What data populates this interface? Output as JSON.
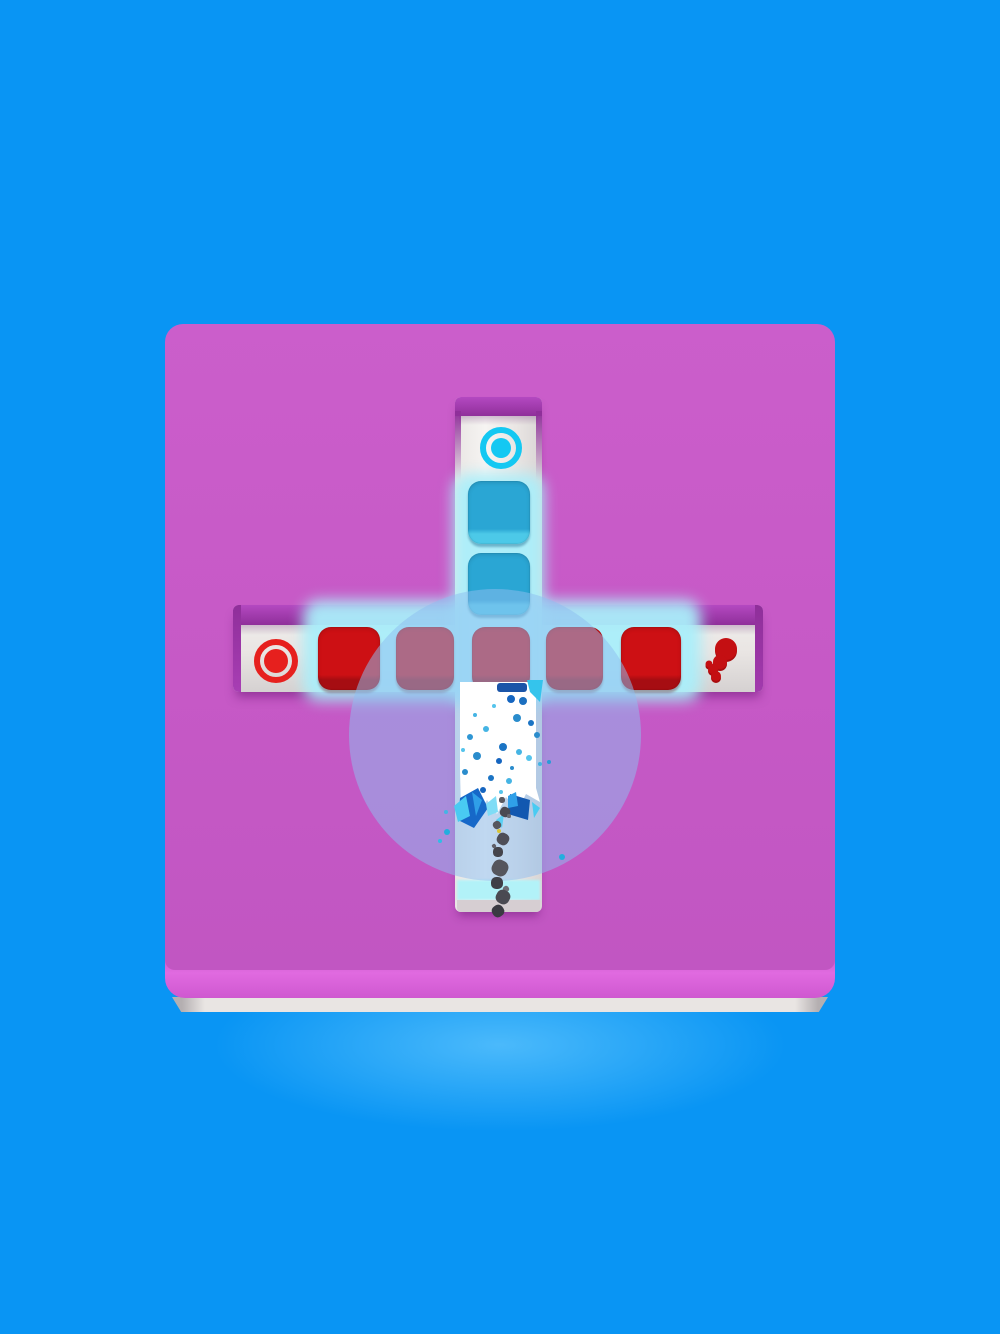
{
  "scene": {
    "width": 1000,
    "height": 1334,
    "app": "block-push-paint-puzzle"
  },
  "colors": {
    "background_blue": "#0995f4",
    "board_pink": "#c75ac7",
    "board_bevel_pink": "#d55fd7",
    "board_base_gray": "#e6e2e0",
    "groove_lip_purple": "#9d39aa",
    "track_white": "#f6f4f2",
    "glow_cyan": "#bdeef8",
    "blue_block": "#2aa6d4",
    "blue_block_bevel": "#4cc9e8",
    "red_block": "#cd1014",
    "red_block_bevel": "#a30d12",
    "ring_cyan": "#14c8f2",
    "ring_red": "#e6201e",
    "splat_red": "#c40f12",
    "splat_red_dark": "#a80b0e",
    "overlay_lavender": "rgba(141,189,240,0.52)",
    "paint_white": "#ffffff",
    "cyan_band": "#b2f2f8",
    "track_end_gray": "#d6ced2",
    "crystal_dark_blue": "#1668c8",
    "crystal_blue": "#2f9fe8",
    "crystal_cyan": "#49cbf2",
    "yellow_speck": "#d8c438"
  },
  "blocks": [
    {
      "name": "blue-block-1",
      "x": 468,
      "y": 481,
      "w": 62,
      "h": 63,
      "top": "#2aa6d4",
      "bevel": "#4cc9e8",
      "shadow": "rgba(10,90,130,0.4)"
    },
    {
      "name": "blue-block-2",
      "x": 468,
      "y": 553,
      "w": 62,
      "h": 62,
      "top": "#2aa6d4",
      "bevel": "#4cc9e8",
      "shadow": "rgba(10,90,130,0.4)"
    },
    {
      "name": "red-block-1",
      "x": 318,
      "y": 627,
      "w": 62,
      "h": 63,
      "top": "#cd1014",
      "bevel": "#a60d12",
      "shadow": "rgba(110,8,14,0.35)"
    },
    {
      "name": "red-block-2",
      "x": 396,
      "y": 627,
      "w": 58,
      "h": 63,
      "top": "#cd1014",
      "bevel": "#a60d12",
      "shadow": "rgba(110,8,14,0.35)"
    },
    {
      "name": "red-block-3",
      "x": 472,
      "y": 627,
      "w": 58,
      "h": 63,
      "top": "#cd1014",
      "bevel": "#a60d12",
      "shadow": "rgba(110,8,14,0.35)"
    },
    {
      "name": "red-block-4",
      "x": 546,
      "y": 627,
      "w": 57,
      "h": 63,
      "top": "#cd1014",
      "bevel": "#a60d12",
      "shadow": "rgba(110,8,14,0.35)"
    },
    {
      "name": "red-block-5",
      "x": 621,
      "y": 627,
      "w": 60,
      "h": 63,
      "top": "#cd1014",
      "bevel": "#a60d12",
      "shadow": "rgba(110,8,14,0.35)"
    }
  ],
  "targets": [
    {
      "name": "blue-goal-ring",
      "cx": 501,
      "cy": 448,
      "outer": 42,
      "stroke": 6,
      "dot": 20,
      "color": "#14c8f2"
    },
    {
      "name": "red-goal-ring",
      "cx": 276,
      "cy": 661,
      "outer": 44,
      "stroke": 6,
      "dot": 24,
      "color": "#e6201e"
    }
  ],
  "overlay_circle": {
    "cx": 495,
    "cy": 735,
    "r": 146,
    "fill": "rgba(141,189,240,0.52)"
  },
  "paint": {
    "white_polygon": "8,2 84,2 84,108 88,122 74,114 66,130 54,117 45,134 35,120 25,135 16,121 9,130 8,90",
    "navy_streak": {
      "x": 497,
      "y": 683,
      "w": 30,
      "h": 9,
      "color": "#1b55a8"
    },
    "cyan_streak_points": "75,0 91,0 88,22 78,12",
    "cyan_streak_color": "#34c4ec",
    "blue_dots": [
      [
        511,
        699,
        4,
        "#1565c0"
      ],
      [
        523,
        701,
        4,
        "#1b6fc0"
      ],
      [
        517,
        718,
        4,
        "#2a8ccc"
      ],
      [
        486,
        729,
        3,
        "#45b4e4"
      ],
      [
        470,
        737,
        3,
        "#2f96d4"
      ],
      [
        503,
        747,
        4,
        "#1b74c4"
      ],
      [
        519,
        752,
        3,
        "#45b4e4"
      ],
      [
        477,
        756,
        4,
        "#2a8ccc"
      ],
      [
        499,
        761,
        3,
        "#1565c0"
      ],
      [
        529,
        758,
        3,
        "#55c4ec"
      ],
      [
        465,
        772,
        3,
        "#2a8ccc"
      ],
      [
        491,
        778,
        3,
        "#1b74c4"
      ],
      [
        509,
        781,
        3,
        "#45b4e4"
      ],
      [
        483,
        790,
        3,
        "#1565c0"
      ],
      [
        501,
        792,
        2,
        "#55c4ec"
      ],
      [
        537,
        735,
        3,
        "#2a8ccc"
      ],
      [
        475,
        715,
        2,
        "#45b4e4"
      ],
      [
        494,
        706,
        2,
        "#55c4ec"
      ],
      [
        531,
        723,
        3,
        "#1b74c4"
      ],
      [
        463,
        750,
        2,
        "#55c4ec"
      ],
      [
        512,
        768,
        2,
        "#2a8ccc"
      ],
      [
        540,
        764,
        2,
        "#45b4e4"
      ]
    ],
    "stray_dots": [
      [
        447,
        832,
        3,
        "#22aede"
      ],
      [
        440,
        841,
        2,
        "#2fbde6"
      ],
      [
        549,
        762,
        2,
        "#2a9ad8"
      ],
      [
        562,
        857,
        3,
        "#22aede"
      ],
      [
        446,
        812,
        2,
        "#45b4e4"
      ]
    ],
    "debris": [
      [
        502,
        800,
        3,
        "#5a5a62"
      ],
      [
        505,
        812,
        5,
        "#4a4a52"
      ],
      [
        497,
        825,
        4,
        "#56565e"
      ],
      [
        509,
        816,
        2,
        "#6a6a72"
      ],
      [
        503,
        839,
        6,
        "#4e4e58"
      ],
      [
        494,
        846,
        2,
        "#60606a"
      ],
      [
        498,
        852,
        5,
        "#44444c"
      ],
      [
        500,
        868,
        8,
        "#55555d"
      ],
      [
        506,
        889,
        3,
        "#6e6e76"
      ],
      [
        497,
        883,
        6,
        "#3f3f47"
      ],
      [
        503,
        897,
        7,
        "#4a4a52"
      ],
      [
        498,
        911,
        6,
        "#3a3a42"
      ]
    ],
    "yellow_speck": [
      499,
      831,
      2,
      "#d8c438"
    ]
  },
  "crystals": [
    {
      "points": "8,12 26,2 36,22 22,42 6,34",
      "fill": "#1668c8"
    },
    {
      "points": "2,20 14,10 18,30 6,36",
      "fill": "#49cbf2"
    },
    {
      "points": "20,6 30,14 24,30",
      "fill": "#2f9fe8"
    },
    {
      "points": "34,18 44,10 46,26 36,30",
      "fill": "#7fdcf6"
    },
    {
      "points": "58,8 78,14 76,34 56,28",
      "fill": "#1258b0"
    },
    {
      "points": "56,10 64,6 66,20 56,22",
      "fill": "#2f9fe8"
    },
    {
      "points": "80,16 88,22 82,32",
      "fill": "#49cbf2"
    },
    {
      "points": "44,34 52,28 50,42",
      "fill": "#5ad0f4"
    }
  ],
  "splat": {
    "x": 700,
    "y": 630,
    "w": 50,
    "h": 60,
    "blobs": [
      [
        26,
        19,
        11
      ],
      [
        20,
        32,
        7
      ],
      [
        13,
        39,
        5
      ],
      [
        9,
        34,
        3.5
      ],
      [
        16,
        46,
        5
      ]
    ],
    "color": "#c40f12",
    "shade": "#a80b0e"
  }
}
